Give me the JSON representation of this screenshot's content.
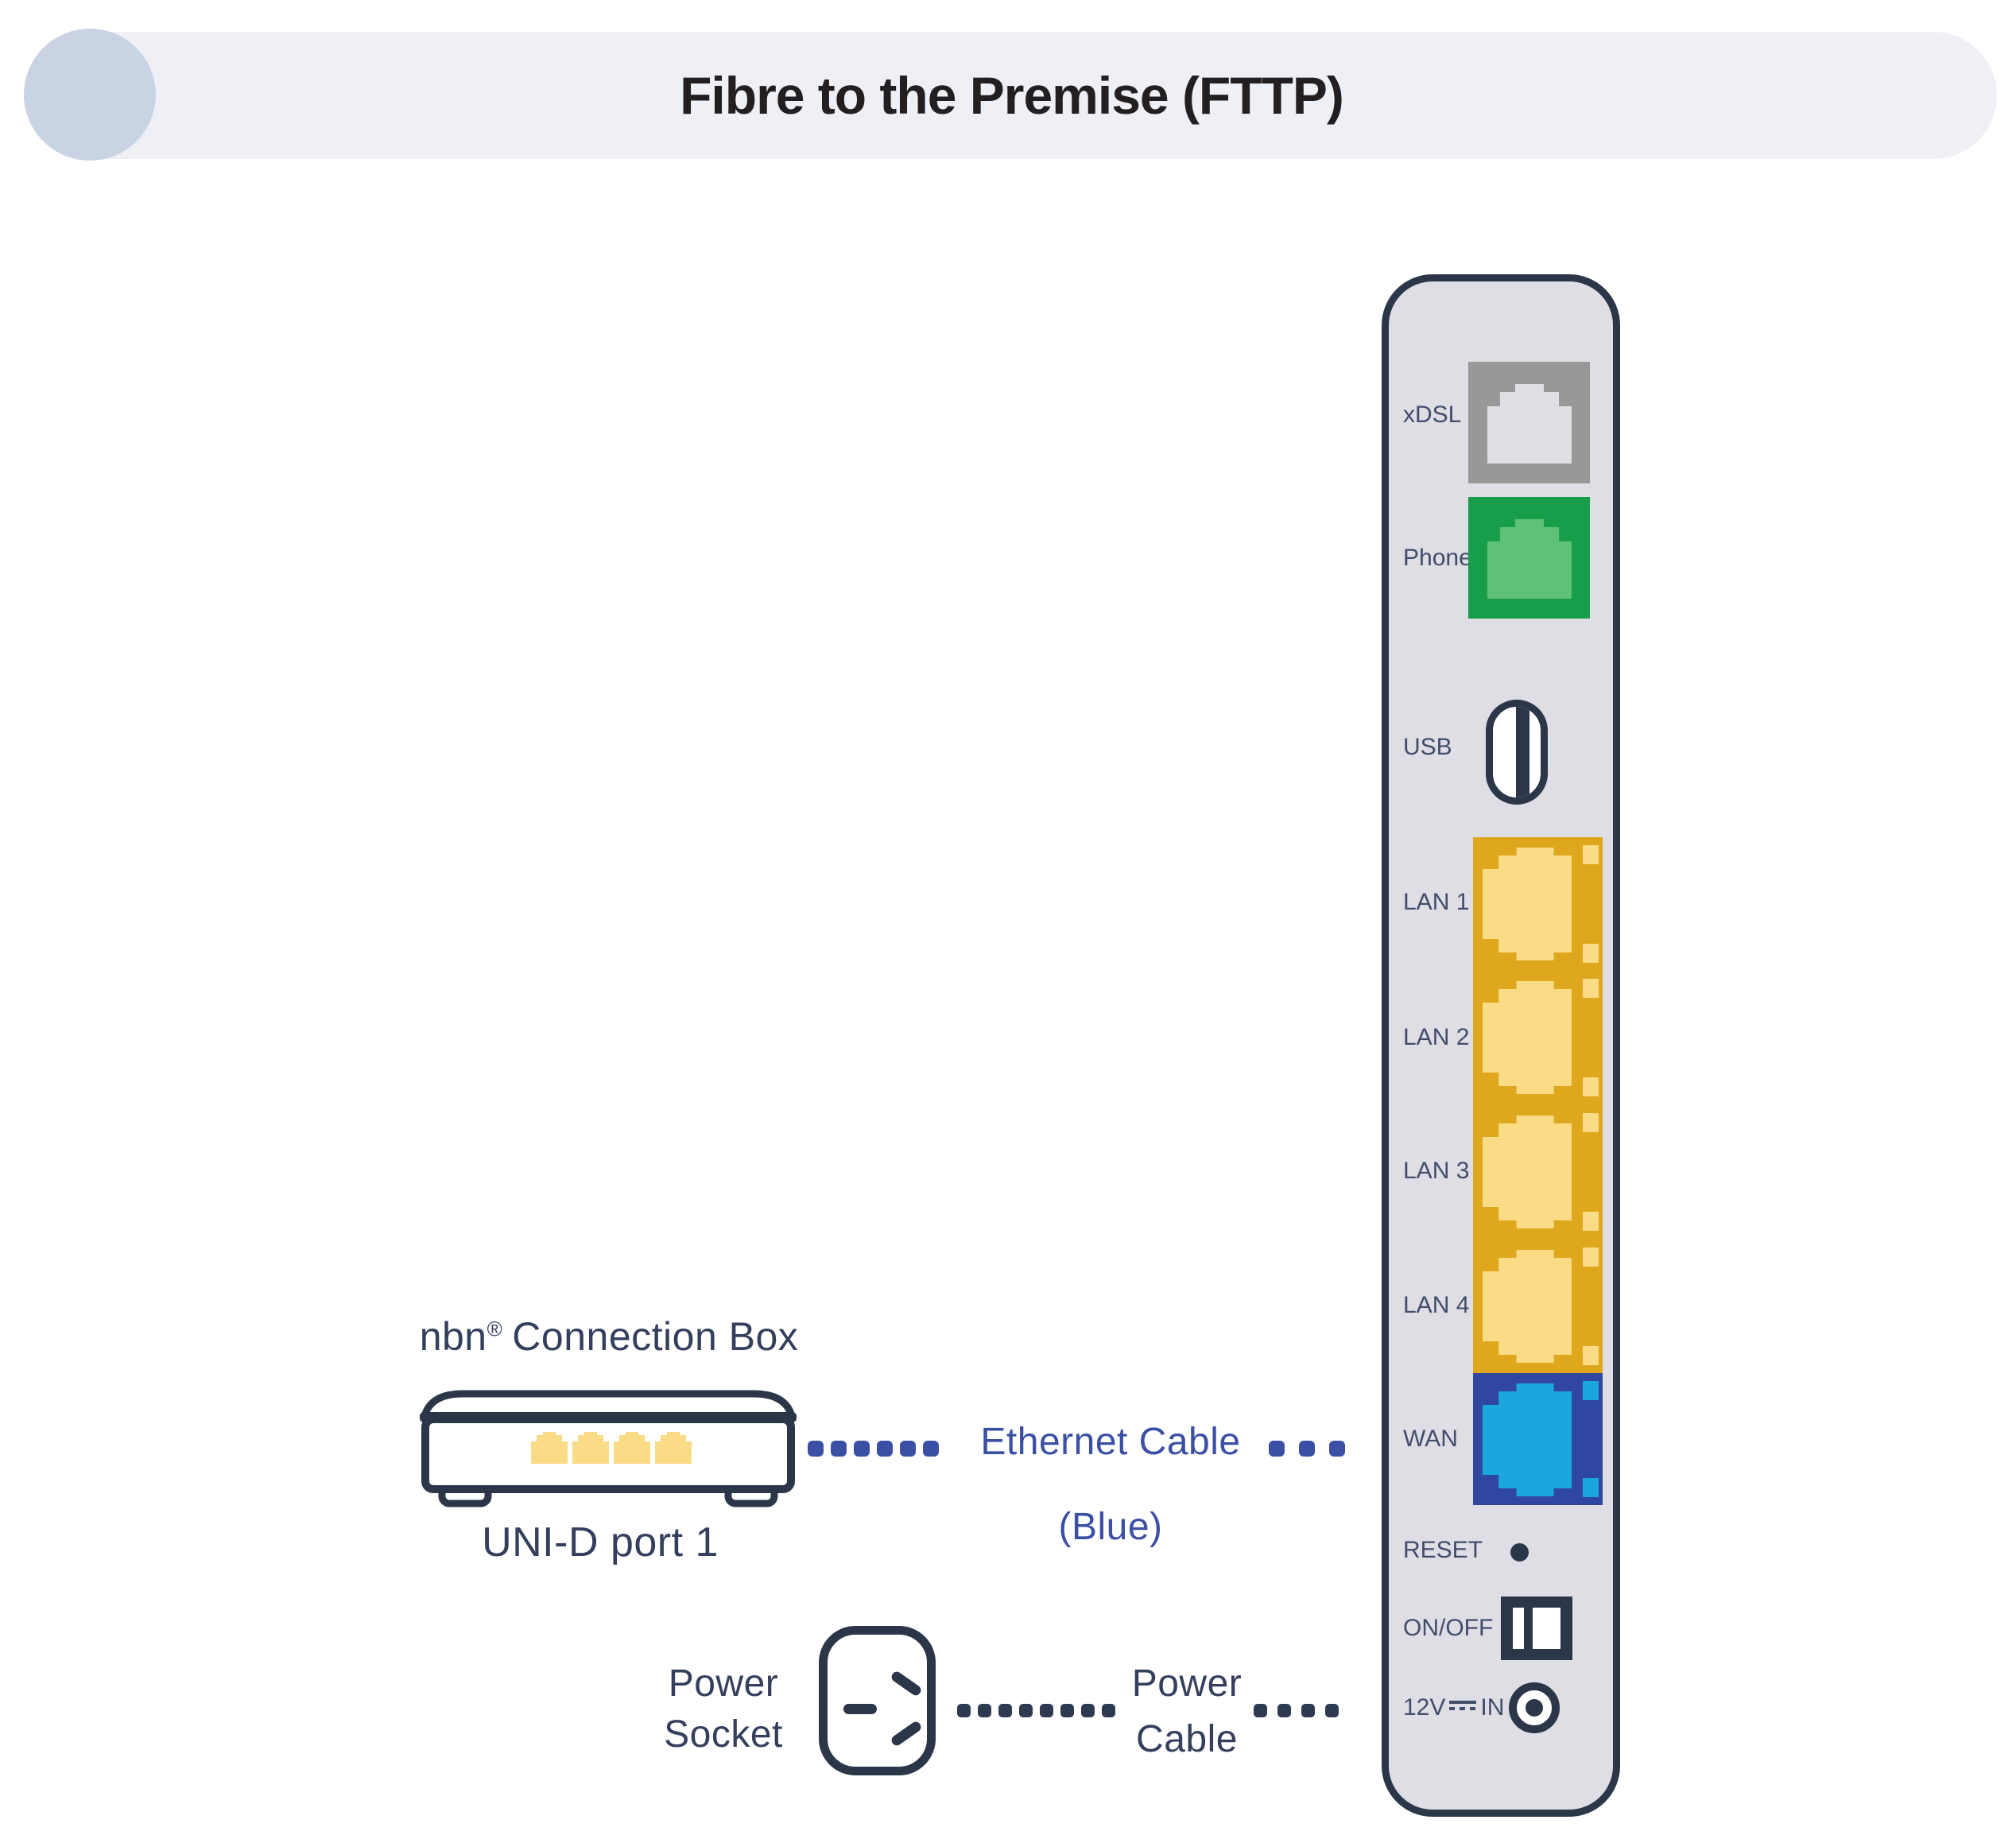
{
  "header": {
    "title": "Fibre to the Premise (FTTP)"
  },
  "panel": {
    "labels": {
      "xdsl": "xDSL",
      "phone": "Phone",
      "usb": "USB",
      "lan1": "LAN 1",
      "lan2": "LAN 2",
      "lan3": "LAN 3",
      "lan4": "LAN 4",
      "wan": "WAN",
      "reset": "RESET",
      "onoff": "ON/OFF",
      "power_in_prefix": "12V",
      "power_in_suffix": "IN"
    }
  },
  "connection_box": {
    "brand": "nbn",
    "reg": "®",
    "rest": "Connection Box",
    "caption": "UNI-D port 1"
  },
  "cables": {
    "ethernet_label": "Ethernet Cable",
    "ethernet_sublabel": "(Blue)",
    "power_socket_line1": "Power",
    "power_socket_line2": "Socket",
    "power_cable_line1": "Power",
    "power_cable_line2": "Cable"
  },
  "icons": {
    "header_circle": "decorative-circle",
    "xdsl_port": "rj-jack-gray",
    "phone_port": "rj-jack-green",
    "usb_port": "usb-slot",
    "lan_ports": "rj45-jack-yellow",
    "wan_port": "rj45-jack-blue",
    "reset": "pinhole-dot",
    "onoff": "rocker-switch",
    "dc_in": "barrel-jack",
    "dc_symbol": "dc-voltage-symbol",
    "power_socket": "au-power-outlet",
    "cable_dots": "dotted-cable-line"
  },
  "colors": {
    "header_bar": "#eef0f6",
    "header_circle": "#c9d3e3",
    "title_text": "#231f20",
    "panel_fill": "#dedee4",
    "outline_navy": "#2b3649",
    "panel_label": "#414d6b",
    "diagram_label": "#333f5c",
    "ethernet_blue": "#3b50a4",
    "power_dot": "#2e3a4f",
    "xdsl_bg": "#999899",
    "xdsl_jack": "#dfdfe3",
    "phone_bg": "#189e4b",
    "phone_jack": "#5fc077",
    "lan_bg": "#dfa71d",
    "lan_jack": "#f9dc85",
    "wan_bg": "#2f47a0",
    "wan_jack": "#1ba7dd"
  }
}
